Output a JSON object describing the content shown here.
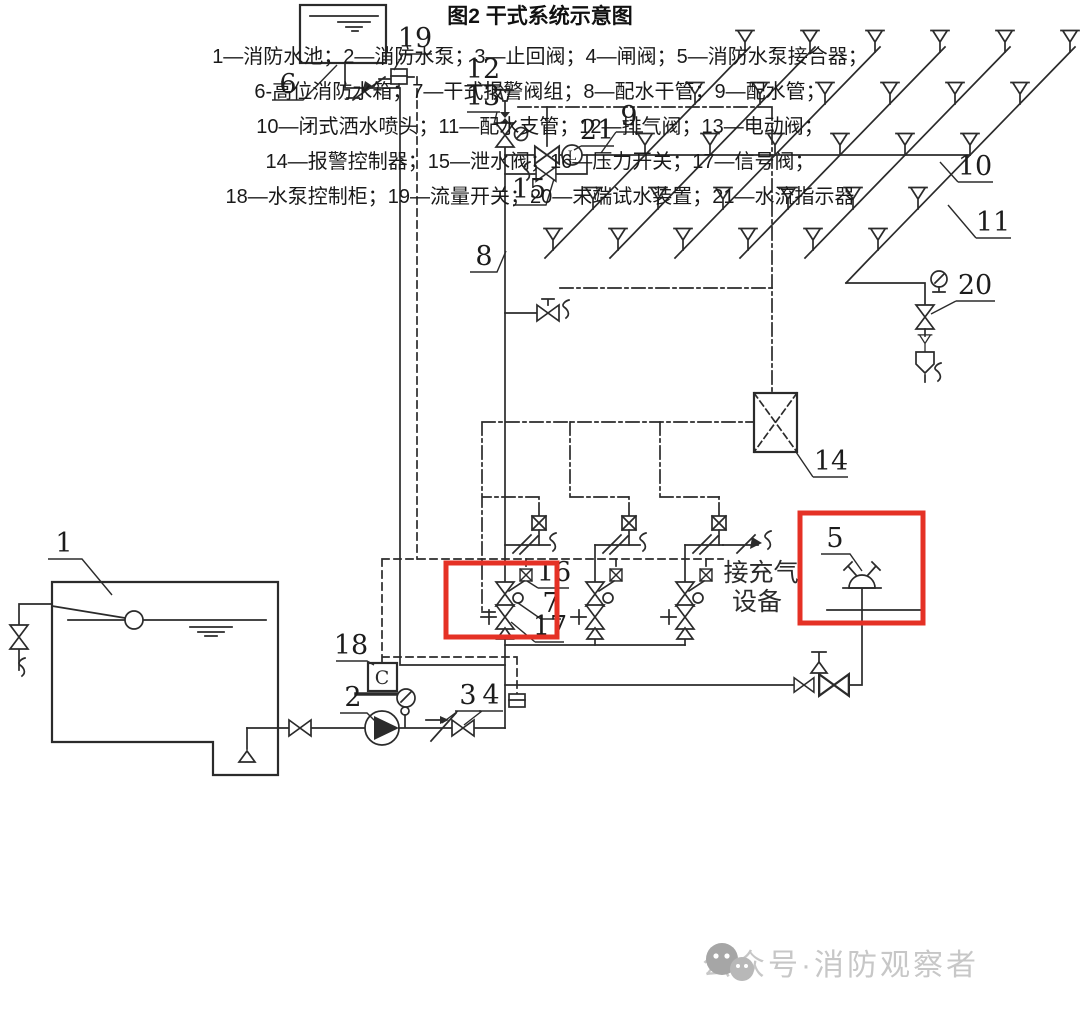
{
  "figure": {
    "caption": "图2 干式系统示意图",
    "legend": [
      "1—消防水池；2—消防水泵；3—止回阀；4—闸阀；5—消防水泵接合器；",
      "6-高位消防水箱；7—干式报警阀组；8—配水干管；9—配水管；",
      "10—闭式洒水喷头；11—配水支管；12—排气阀；13—电动阀；",
      "14—报警控制器；15—泄水阀；16—压力开关；17—信号阀；",
      "18—水泵控制柜；19—流量开关；20—末端试水装置；21—水流指示器"
    ],
    "labels": [
      "1",
      "2",
      "3",
      "4",
      "5",
      "6",
      "7",
      "8",
      "9",
      "10",
      "11",
      "12",
      "13",
      "14",
      "15",
      "16",
      "17",
      "18",
      "19",
      "20",
      "21"
    ],
    "annotations": {
      "air_line1": "接充气",
      "air_line2": "设备",
      "controller_cabinet": "C",
      "flow_indicator": "L"
    },
    "watermark": "公众号·消防观察者",
    "colors": {
      "line": "#2b2b2b",
      "highlight_box": "#e53125",
      "watermark": "#c7c7c7"
    }
  }
}
